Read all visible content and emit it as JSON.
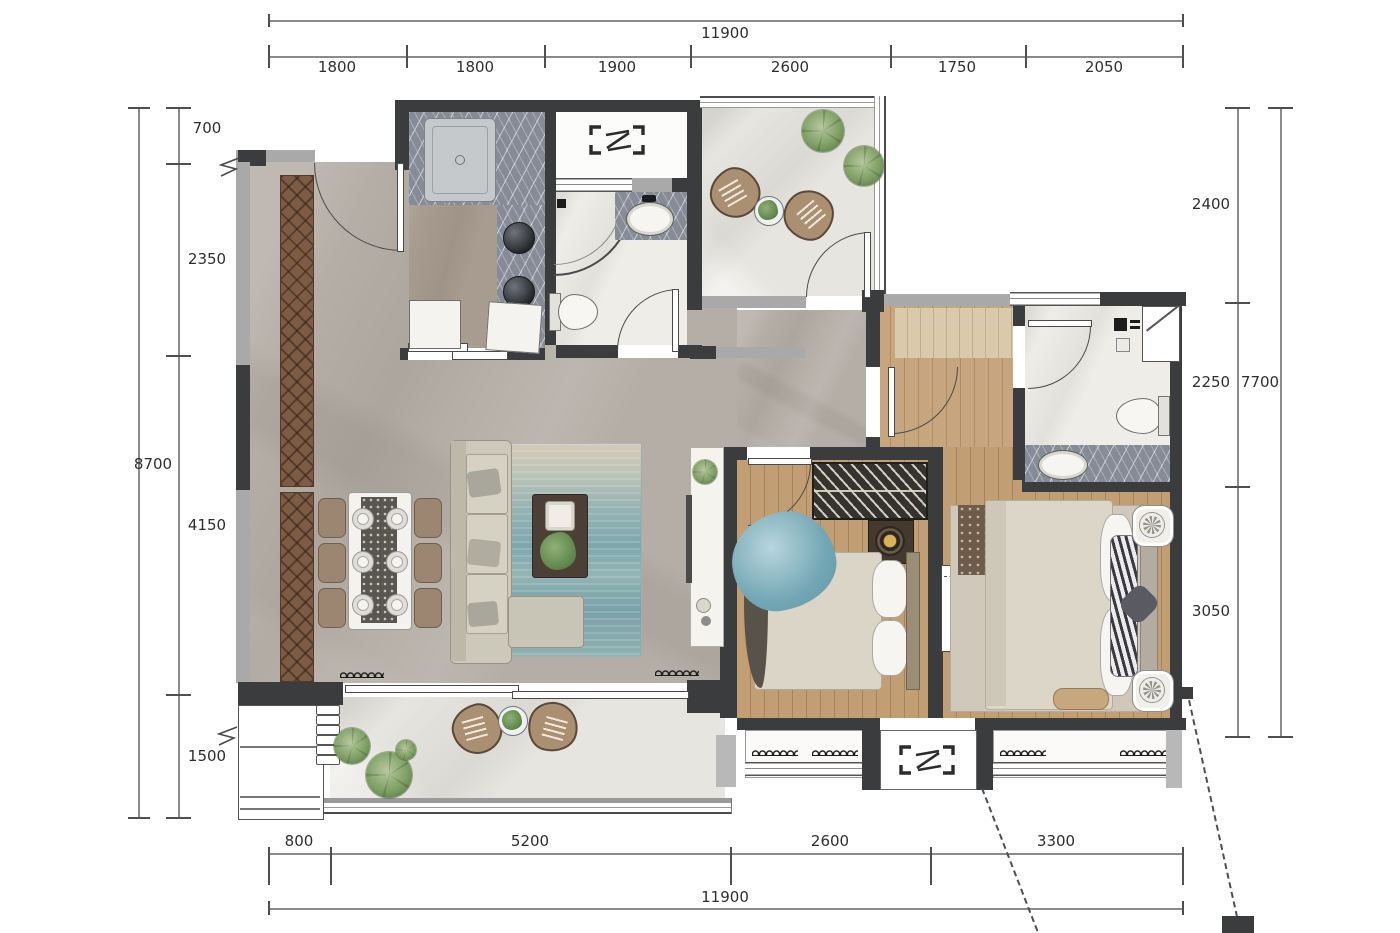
{
  "title": "apartment-floor-plan",
  "dimensions": {
    "top": {
      "total": "11900",
      "segments": [
        "1800",
        "1800",
        "1900",
        "2600",
        "1750",
        "2050"
      ]
    },
    "bottom": {
      "total": "11900",
      "segments": [
        "800",
        "5200",
        "2600",
        "3300"
      ]
    },
    "left": {
      "total": "8700",
      "segments": [
        "700",
        "2350",
        "4150",
        "1500"
      ]
    },
    "right": {
      "total": "7700",
      "segments": [
        "2400",
        "2250",
        "3050"
      ]
    }
  },
  "colors": {
    "wall_dark": "#3b3c3e",
    "wall_light": "#a9a9a9",
    "floor_living_marble": "#b4aea6",
    "floor_wood": "#c29e75",
    "floor_white_marble": "#efede8",
    "counter_dark_marble": "#858c97",
    "wardrobe_wood": "#7c5c44",
    "rug_teal": "#7ea7ad",
    "plant_green": "#7fa065",
    "chair_tan": "#aa8f70",
    "dimension_text": "#2e2e2e"
  },
  "icons": {
    "ac_unit_symbol": "bracketed double-bar [=] outdoor AC platform mark",
    "window_coil": "spring coil mark on window sill",
    "window_break": "zigzag wall-opening mark",
    "door_swing": "quarter-circle arc"
  }
}
